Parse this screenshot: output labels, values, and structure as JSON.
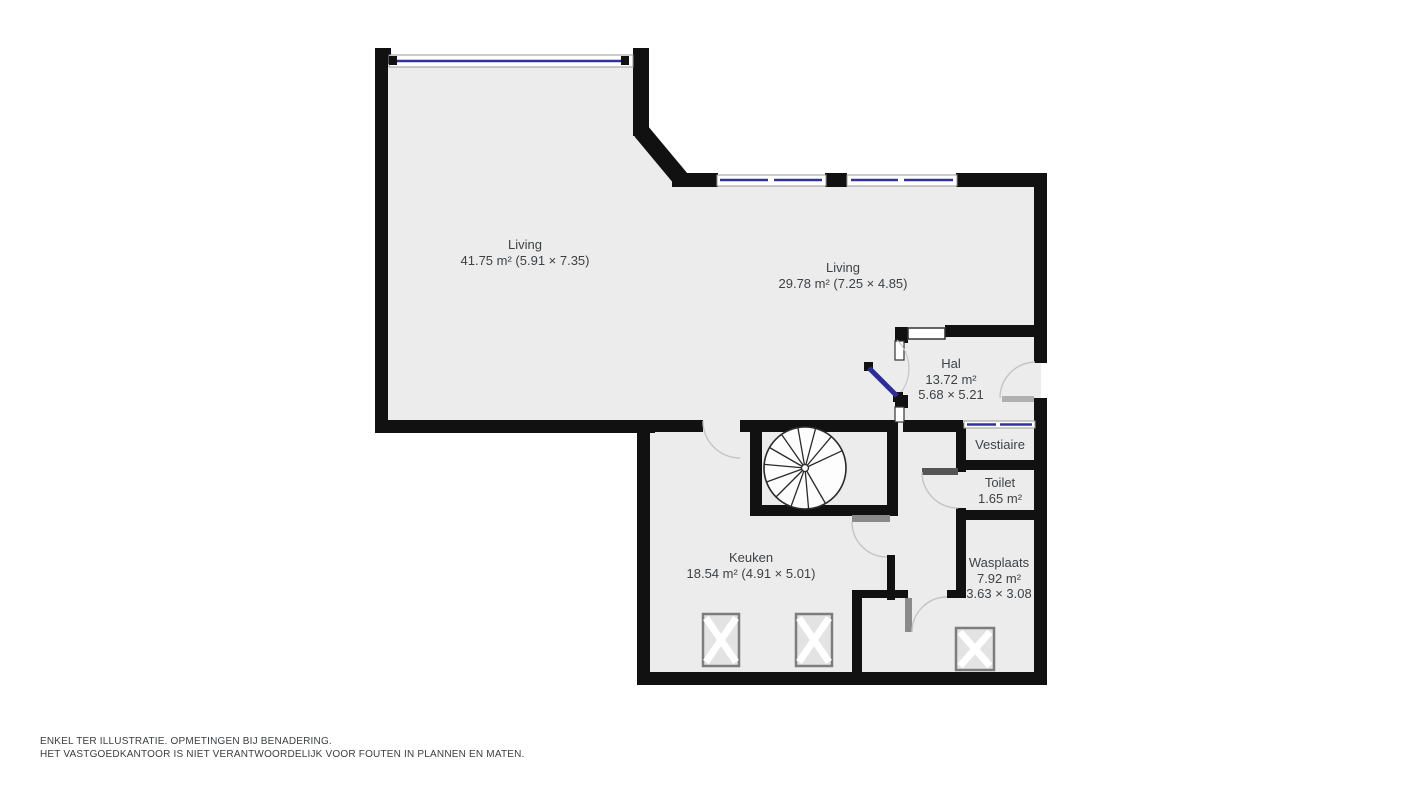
{
  "plan_title": "Floor plan (gelijkvloers)",
  "rooms": {
    "living1": {
      "label": "Living",
      "detail": "41.75 m² (5.91 × 7.35)"
    },
    "living2": {
      "label": "Living",
      "detail": "29.78 m² (7.25 × 4.85)"
    },
    "hal": {
      "label": "Hal",
      "area": "13.72 m²",
      "dims": "5.68 × 5.21"
    },
    "vestiaire": {
      "label": "Vestiaire"
    },
    "toilet": {
      "label": "Toilet",
      "area": "1.65 m²"
    },
    "keuken": {
      "label": "Keuken",
      "detail": "18.54 m² (4.91 × 5.01)"
    },
    "wasplaats": {
      "label": "Wasplaats",
      "area": "7.92 m²",
      "dims": "3.63 × 3.08"
    }
  },
  "disclaimer": {
    "line1": "ENKEL TER ILLUSTRATIE. OPMETINGEN BIJ BENADERING.",
    "line2": "HET VASTGOEDKANTOOR IS NIET VERANTWOORDELIJK VOOR FOUTEN IN PLANNEN EN MATEN."
  },
  "icons": {
    "staircase": "spiral-staircase-icon",
    "appliance": "appliance-crossbox-icon",
    "door": "door-swing-arc",
    "window": "window-glass-line"
  },
  "colors": {
    "wall": "#111111",
    "floor": "#ececec",
    "window_glass": "#32329a",
    "window_frame": "#9a9a9a",
    "door_arc": "#c4c4c4",
    "door_leaf_gray": "#8a8a8a",
    "text": "#3e4245",
    "background": "#ffffff"
  }
}
